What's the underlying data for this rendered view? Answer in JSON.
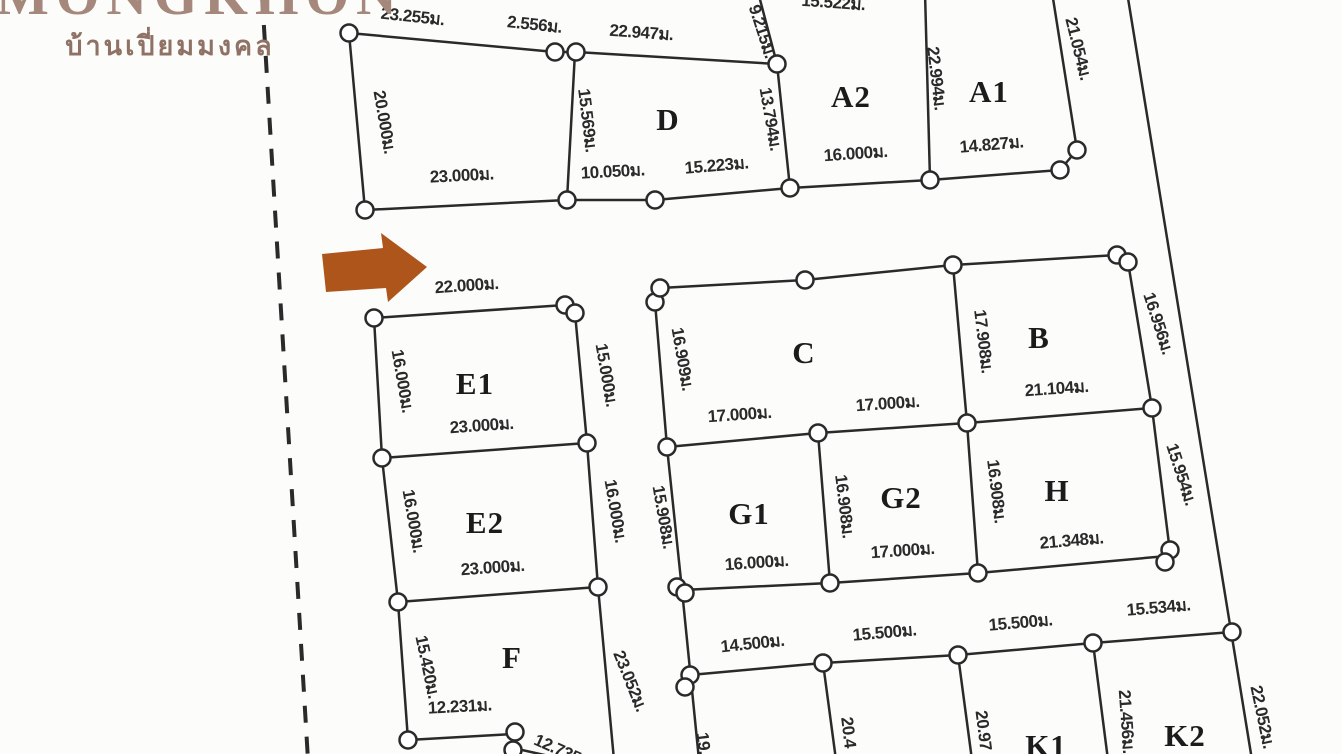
{
  "logo": {
    "brand": "MONGKHON",
    "thai": "บ้านเปี่ยมมงคล"
  },
  "colors": {
    "ink": "#2a2a2a",
    "paper": "#fcfcfa",
    "arrow": "#ae551c",
    "logo_brand": "#a5887b",
    "logo_thai": "#8f7265"
  },
  "map": {
    "unit": "ม.",
    "dashed_boundary": {
      "x1": 262,
      "y1": -6,
      "x2": 308,
      "y2": 760
    },
    "arrow_points": "322,254 383,248 381,233 427,267 388,302 386,288 326,292",
    "edges": [
      [
        349,
        33,
        555,
        52
      ],
      [
        555,
        52,
        576,
        52
      ],
      [
        576,
        52,
        777,
        64
      ],
      [
        777,
        64,
        758,
        -8
      ],
      [
        349,
        33,
        365,
        210
      ],
      [
        575,
        52,
        567,
        200
      ],
      [
        777,
        64,
        790,
        188
      ],
      [
        365,
        210,
        567,
        200
      ],
      [
        567,
        200,
        655,
        200
      ],
      [
        655,
        200,
        790,
        188
      ],
      [
        790,
        188,
        930,
        180
      ],
      [
        930,
        180,
        1060,
        170
      ],
      [
        1060,
        170,
        1077,
        150
      ],
      [
        925,
        -8,
        930,
        180
      ],
      [
        1052,
        -8,
        1077,
        150
      ],
      [
        1127,
        -8,
        1252,
        760
      ],
      [
        374,
        318,
        565,
        305
      ],
      [
        374,
        318,
        382,
        458
      ],
      [
        575,
        313,
        587,
        443
      ],
      [
        382,
        458,
        587,
        443
      ],
      [
        382,
        458,
        398,
        602
      ],
      [
        587,
        443,
        598,
        587
      ],
      [
        398,
        602,
        598,
        587
      ],
      [
        398,
        602,
        408,
        740
      ],
      [
        598,
        587,
        614,
        760
      ],
      [
        408,
        740,
        513,
        734
      ],
      [
        513,
        748,
        585,
        764
      ],
      [
        660,
        288,
        805,
        280
      ],
      [
        805,
        280,
        953,
        265
      ],
      [
        953,
        265,
        1117,
        255
      ],
      [
        655,
        302,
        667,
        447
      ],
      [
        953,
        265,
        967,
        423
      ],
      [
        1128,
        262,
        1152,
        408
      ],
      [
        967,
        423,
        1152,
        408
      ],
      [
        667,
        447,
        818,
        433
      ],
      [
        818,
        433,
        967,
        423
      ],
      [
        667,
        447,
        682,
        590
      ],
      [
        818,
        433,
        830,
        583
      ],
      [
        967,
        423,
        978,
        573
      ],
      [
        1152,
        408,
        1170,
        552
      ],
      [
        682,
        590,
        830,
        583
      ],
      [
        830,
        583,
        978,
        573
      ],
      [
        978,
        573,
        1167,
        556
      ],
      [
        682,
        590,
        699,
        760
      ],
      [
        690,
        675,
        823,
        663
      ],
      [
        823,
        663,
        958,
        655
      ],
      [
        958,
        655,
        1093,
        643
      ],
      [
        1093,
        643,
        1232,
        632
      ],
      [
        823,
        663,
        836,
        760
      ],
      [
        958,
        655,
        972,
        760
      ],
      [
        1093,
        643,
        1108,
        760
      ]
    ],
    "markers": [
      [
        349,
        33
      ],
      [
        555,
        52
      ],
      [
        576,
        52
      ],
      [
        777,
        64
      ],
      [
        365,
        210
      ],
      [
        567,
        200
      ],
      [
        655,
        200
      ],
      [
        790,
        188
      ],
      [
        930,
        180
      ],
      [
        1060,
        170
      ],
      [
        1077,
        150
      ],
      [
        374,
        318
      ],
      [
        565,
        305
      ],
      [
        575,
        313
      ],
      [
        655,
        302
      ],
      [
        660,
        288
      ],
      [
        805,
        280
      ],
      [
        953,
        265
      ],
      [
        1117,
        255
      ],
      [
        1128,
        262
      ],
      [
        382,
        458
      ],
      [
        587,
        443
      ],
      [
        818,
        433
      ],
      [
        967,
        423
      ],
      [
        1152,
        408
      ],
      [
        398,
        602
      ],
      [
        598,
        587
      ],
      [
        667,
        447
      ],
      [
        677,
        587
      ],
      [
        685,
        593
      ],
      [
        830,
        583
      ],
      [
        978,
        573
      ],
      [
        1170,
        550
      ],
      [
        1165,
        562
      ],
      [
        690,
        675
      ],
      [
        685,
        687
      ],
      [
        823,
        663
      ],
      [
        958,
        655
      ],
      [
        1093,
        643
      ],
      [
        1232,
        632
      ],
      [
        408,
        740
      ],
      [
        515,
        732
      ],
      [
        513,
        750
      ]
    ],
    "measurements": [
      {
        "text": "23.255ม.",
        "x": 412,
        "y": 22,
        "rot": 6
      },
      {
        "text": "2.556ม.",
        "x": 534,
        "y": 30,
        "rot": 6
      },
      {
        "text": "22.947ม.",
        "x": 641,
        "y": 38,
        "rot": 4
      },
      {
        "text": "15.522ม.",
        "x": 833,
        "y": 8,
        "rot": 4
      },
      {
        "text": "9.215ม.",
        "x": 757,
        "y": 33,
        "rot": 72
      },
      {
        "text": "21.054ม.",
        "x": 1073,
        "y": 50,
        "rot": 76
      },
      {
        "text": "20.000ม.",
        "x": 379,
        "y": 123,
        "rot": 80
      },
      {
        "text": "15.569ม.",
        "x": 582,
        "y": 121,
        "rot": 83
      },
      {
        "text": "13.794ม.",
        "x": 765,
        "y": 120,
        "rot": 80
      },
      {
        "text": "22.994ม.",
        "x": 931,
        "y": 79,
        "rot": 83
      },
      {
        "text": "23.000ม.",
        "x": 462,
        "y": 181,
        "rot": -3
      },
      {
        "text": "10.050ม.",
        "x": 613,
        "y": 177,
        "rot": -3
      },
      {
        "text": "15.223ม.",
        "x": 717,
        "y": 171,
        "rot": -5
      },
      {
        "text": "16.000ม.",
        "x": 856,
        "y": 159,
        "rot": -4
      },
      {
        "text": "14.827ม.",
        "x": 992,
        "y": 150,
        "rot": -5
      },
      {
        "text": "22.000ม.",
        "x": 467,
        "y": 291,
        "rot": -4
      },
      {
        "text": "16.000ม.",
        "x": 397,
        "y": 382,
        "rot": 80
      },
      {
        "text": "15.000ม.",
        "x": 601,
        "y": 376,
        "rot": 80
      },
      {
        "text": "23.000ม.",
        "x": 482,
        "y": 431,
        "rot": -4
      },
      {
        "text": "16.909ม.",
        "x": 677,
        "y": 360,
        "rot": 80
      },
      {
        "text": "17.908ม.",
        "x": 978,
        "y": 342,
        "rot": 83
      },
      {
        "text": "16.956ม.",
        "x": 1153,
        "y": 325,
        "rot": 72
      },
      {
        "text": "21.104ม.",
        "x": 1057,
        "y": 394,
        "rot": -4
      },
      {
        "text": "17.000ม.",
        "x": 740,
        "y": 420,
        "rot": -4
      },
      {
        "text": "17.000ม.",
        "x": 888,
        "y": 409,
        "rot": -4
      },
      {
        "text": "16.000ม.",
        "x": 408,
        "y": 522,
        "rot": 80
      },
      {
        "text": "16.000ม.",
        "x": 610,
        "y": 512,
        "rot": 80
      },
      {
        "text": "23.000ม.",
        "x": 493,
        "y": 573,
        "rot": -4
      },
      {
        "text": "15.908ม.",
        "x": 658,
        "y": 518,
        "rot": 80
      },
      {
        "text": "16.908ม.",
        "x": 839,
        "y": 507,
        "rot": 83
      },
      {
        "text": "16.908ม.",
        "x": 991,
        "y": 492,
        "rot": 83
      },
      {
        "text": "15.954ม.",
        "x": 1176,
        "y": 476,
        "rot": 72
      },
      {
        "text": "21.348ม.",
        "x": 1072,
        "y": 546,
        "rot": -5
      },
      {
        "text": "16.000ม.",
        "x": 757,
        "y": 568,
        "rot": -4
      },
      {
        "text": "17.000ม.",
        "x": 903,
        "y": 556,
        "rot": -4
      },
      {
        "text": "15.420ม.",
        "x": 422,
        "y": 668,
        "rot": 78
      },
      {
        "text": "23.052ม.",
        "x": 625,
        "y": 683,
        "rot": 68
      },
      {
        "text": "12.231ม.",
        "x": 460,
        "y": 712,
        "rot": -3
      },
      {
        "text": "12.735ม.",
        "x": 562,
        "y": 757,
        "rot": 24
      },
      {
        "text": "14.500ม.",
        "x": 753,
        "y": 649,
        "rot": -6
      },
      {
        "text": "15.500ม.",
        "x": 885,
        "y": 638,
        "rot": -5
      },
      {
        "text": "15.500ม.",
        "x": 1021,
        "y": 628,
        "rot": -5
      },
      {
        "text": "15.534ม.",
        "x": 1159,
        "y": 613,
        "rot": -5
      },
      {
        "text": "19.",
        "x": 698,
        "y": 744,
        "rot": 83
      },
      {
        "text": "20.4",
        "x": 843,
        "y": 733,
        "rot": 83
      },
      {
        "text": "20.97",
        "x": 978,
        "y": 731,
        "rot": 83
      },
      {
        "text": "21.456ม.",
        "x": 1121,
        "y": 722,
        "rot": 86
      },
      {
        "text": "22.052ม.",
        "x": 1257,
        "y": 718,
        "rot": 78
      }
    ],
    "lots": [
      {
        "name": "D",
        "x": 668,
        "y": 130
      },
      {
        "name": "A2",
        "x": 851,
        "y": 107
      },
      {
        "name": "A1",
        "x": 989,
        "y": 102
      },
      {
        "name": "E1",
        "x": 475,
        "y": 394
      },
      {
        "name": "C",
        "x": 804,
        "y": 363
      },
      {
        "name": "B",
        "x": 1039,
        "y": 348
      },
      {
        "name": "E2",
        "x": 485,
        "y": 533
      },
      {
        "name": "G1",
        "x": 749,
        "y": 524
      },
      {
        "name": "G2",
        "x": 901,
        "y": 508
      },
      {
        "name": "H",
        "x": 1057,
        "y": 501
      },
      {
        "name": "F",
        "x": 512,
        "y": 668
      },
      {
        "name": "I",
        "x": 760,
        "y": 776
      },
      {
        "name": "J",
        "x": 910,
        "y": 774
      },
      {
        "name": "K1",
        "x": 1046,
        "y": 756
      },
      {
        "name": "K2",
        "x": 1185,
        "y": 746
      }
    ]
  }
}
